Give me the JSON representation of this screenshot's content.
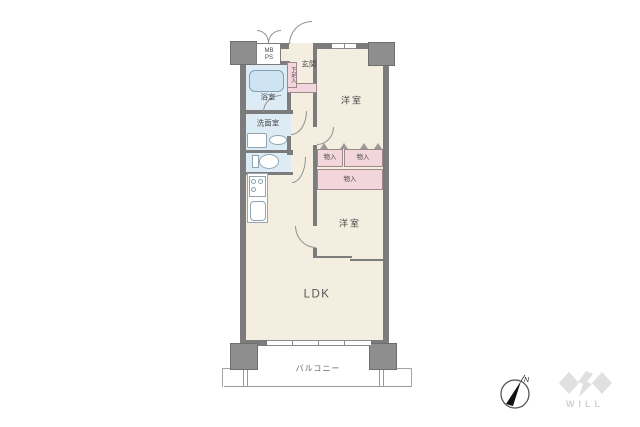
{
  "floorplan": {
    "labels": {
      "genkan": "玄関",
      "shoe_cabinet": "下足入",
      "mb": "MB",
      "ps": "PS",
      "bathroom": "浴室",
      "washroom": "洗面室",
      "western_room_1": "洋室",
      "western_room_2": "洋室",
      "closet_1": "物入",
      "closet_2": "物入",
      "closet_3": "物入",
      "ldk": "LDK",
      "balcony": "バルコニー"
    },
    "colors": {
      "wall": "#7c7c7c",
      "pillar": "#8e8e8e",
      "cream": "#f4eee0",
      "wet": "#dcebf4",
      "pink": "#f3d5dc",
      "fixture": "#8fa3b2",
      "tub": "#cfe4f2",
      "tub_border": "#81a0b4",
      "line": "#909090",
      "text": "#4a4a4a",
      "logo": "#e0e0e0",
      "logo_text": "#d2d2d2"
    }
  },
  "compass": {
    "north": "N"
  },
  "brand": {
    "logo_text": "WILL"
  }
}
